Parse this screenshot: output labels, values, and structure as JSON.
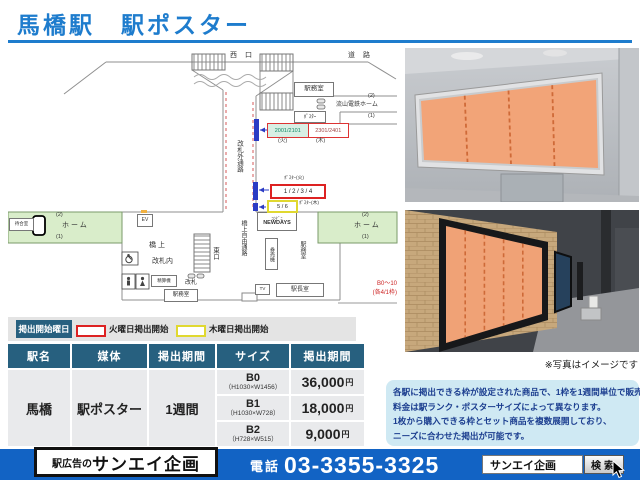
{
  "header": {
    "title": "馬橋駅　駅ポスター"
  },
  "diagram": {
    "top": {
      "west_exit": "西 口",
      "road": "道 路",
      "office": "駅務室",
      "track2": "(2)",
      "line_name": "流山電鉄ホーム",
      "track1": "(1)"
    },
    "upper_poster": {
      "tag": "ﾎﾟｽﾀｰ",
      "frames_a": "2001/2101",
      "frames_b": "2301/2401",
      "tue": "(火)",
      "thu": "(木)"
    },
    "corridor": {
      "outside": "改札外通路",
      "free_passage": "橋上自由通路",
      "east_exit": "東口"
    },
    "left_platform": {
      "track2": "(2)",
      "name": "ホーム",
      "track1": "(1)",
      "waiting": "待合室"
    },
    "right_platform": {
      "track2": "(2)",
      "name": "ホーム",
      "track1": "(1)"
    },
    "concourse": {
      "ev": "EV",
      "bridge": "橋上",
      "inside_gate": "改札内",
      "fare": "精算機",
      "gate": "改札",
      "office": "駅務室",
      "conv_type": "ｺﾝﾋﾞﾆ",
      "conv_name": "NEWDAYS",
      "ticket": "券売機",
      "office_side": "駅務室",
      "master": "駅長室",
      "tv": "TV"
    },
    "lower_poster": {
      "tue_label": "ﾎﾟｽﾀｰ(火)",
      "tue_frames": "1 / 2 / 3 / 4",
      "thu_frames": "5 / 6",
      "thu_label": "ﾎﾟｽﾀｰ(木)"
    },
    "note": {
      "line1": "B0～10",
      "line2": "(各4/1枠)"
    }
  },
  "legend": {
    "title": "掲出開始曜日",
    "tue": "火曜日掲出開始",
    "thu": "木曜日掲出開始"
  },
  "table": {
    "headers": [
      "駅名",
      "媒体",
      "掲出期間",
      "サイズ",
      "掲出期間"
    ],
    "station": "馬橋",
    "media": "駅ポスター",
    "period": "1週間",
    "rows": [
      {
        "size": "B0",
        "dims": "（H1030×W1456）",
        "price": "36,000",
        "unit": "円"
      },
      {
        "size": "B1",
        "dims": "（H1030×W728）",
        "price": "18,000",
        "unit": "円"
      },
      {
        "size": "B2",
        "dims": "（H728×W515）",
        "price": "9,000",
        "unit": "円"
      }
    ]
  },
  "photos": {
    "caption": "※写真はイメージです"
  },
  "info": {
    "lines": [
      "各駅に掲出できる枠が設定された商品で、1枠を1週間単位で販売。",
      "料金は駅ランク・ポスターサイズによって異なります。",
      "1枚から購入できる枠とセット商品を複数展開しており、",
      "ニーズに合わせた掲出が可能です。"
    ]
  },
  "footer": {
    "logo_prefix": "駅広告の",
    "logo_name": "サンエイ企画",
    "phone_label": "電話",
    "phone_number": "03-3355-3325",
    "search_value": "サンエイ企画",
    "search_button": "検索"
  },
  "colors": {
    "accent_blue": "#1e7ccd",
    "footer_blue": "#1263c4",
    "table_header": "#27607f",
    "poster_orange": "#f2a478",
    "legend_red": "#dd2222",
    "legend_yellow": "#e0d830",
    "platform_green": "#d9edca",
    "info_bg": "#cfe9f3"
  }
}
